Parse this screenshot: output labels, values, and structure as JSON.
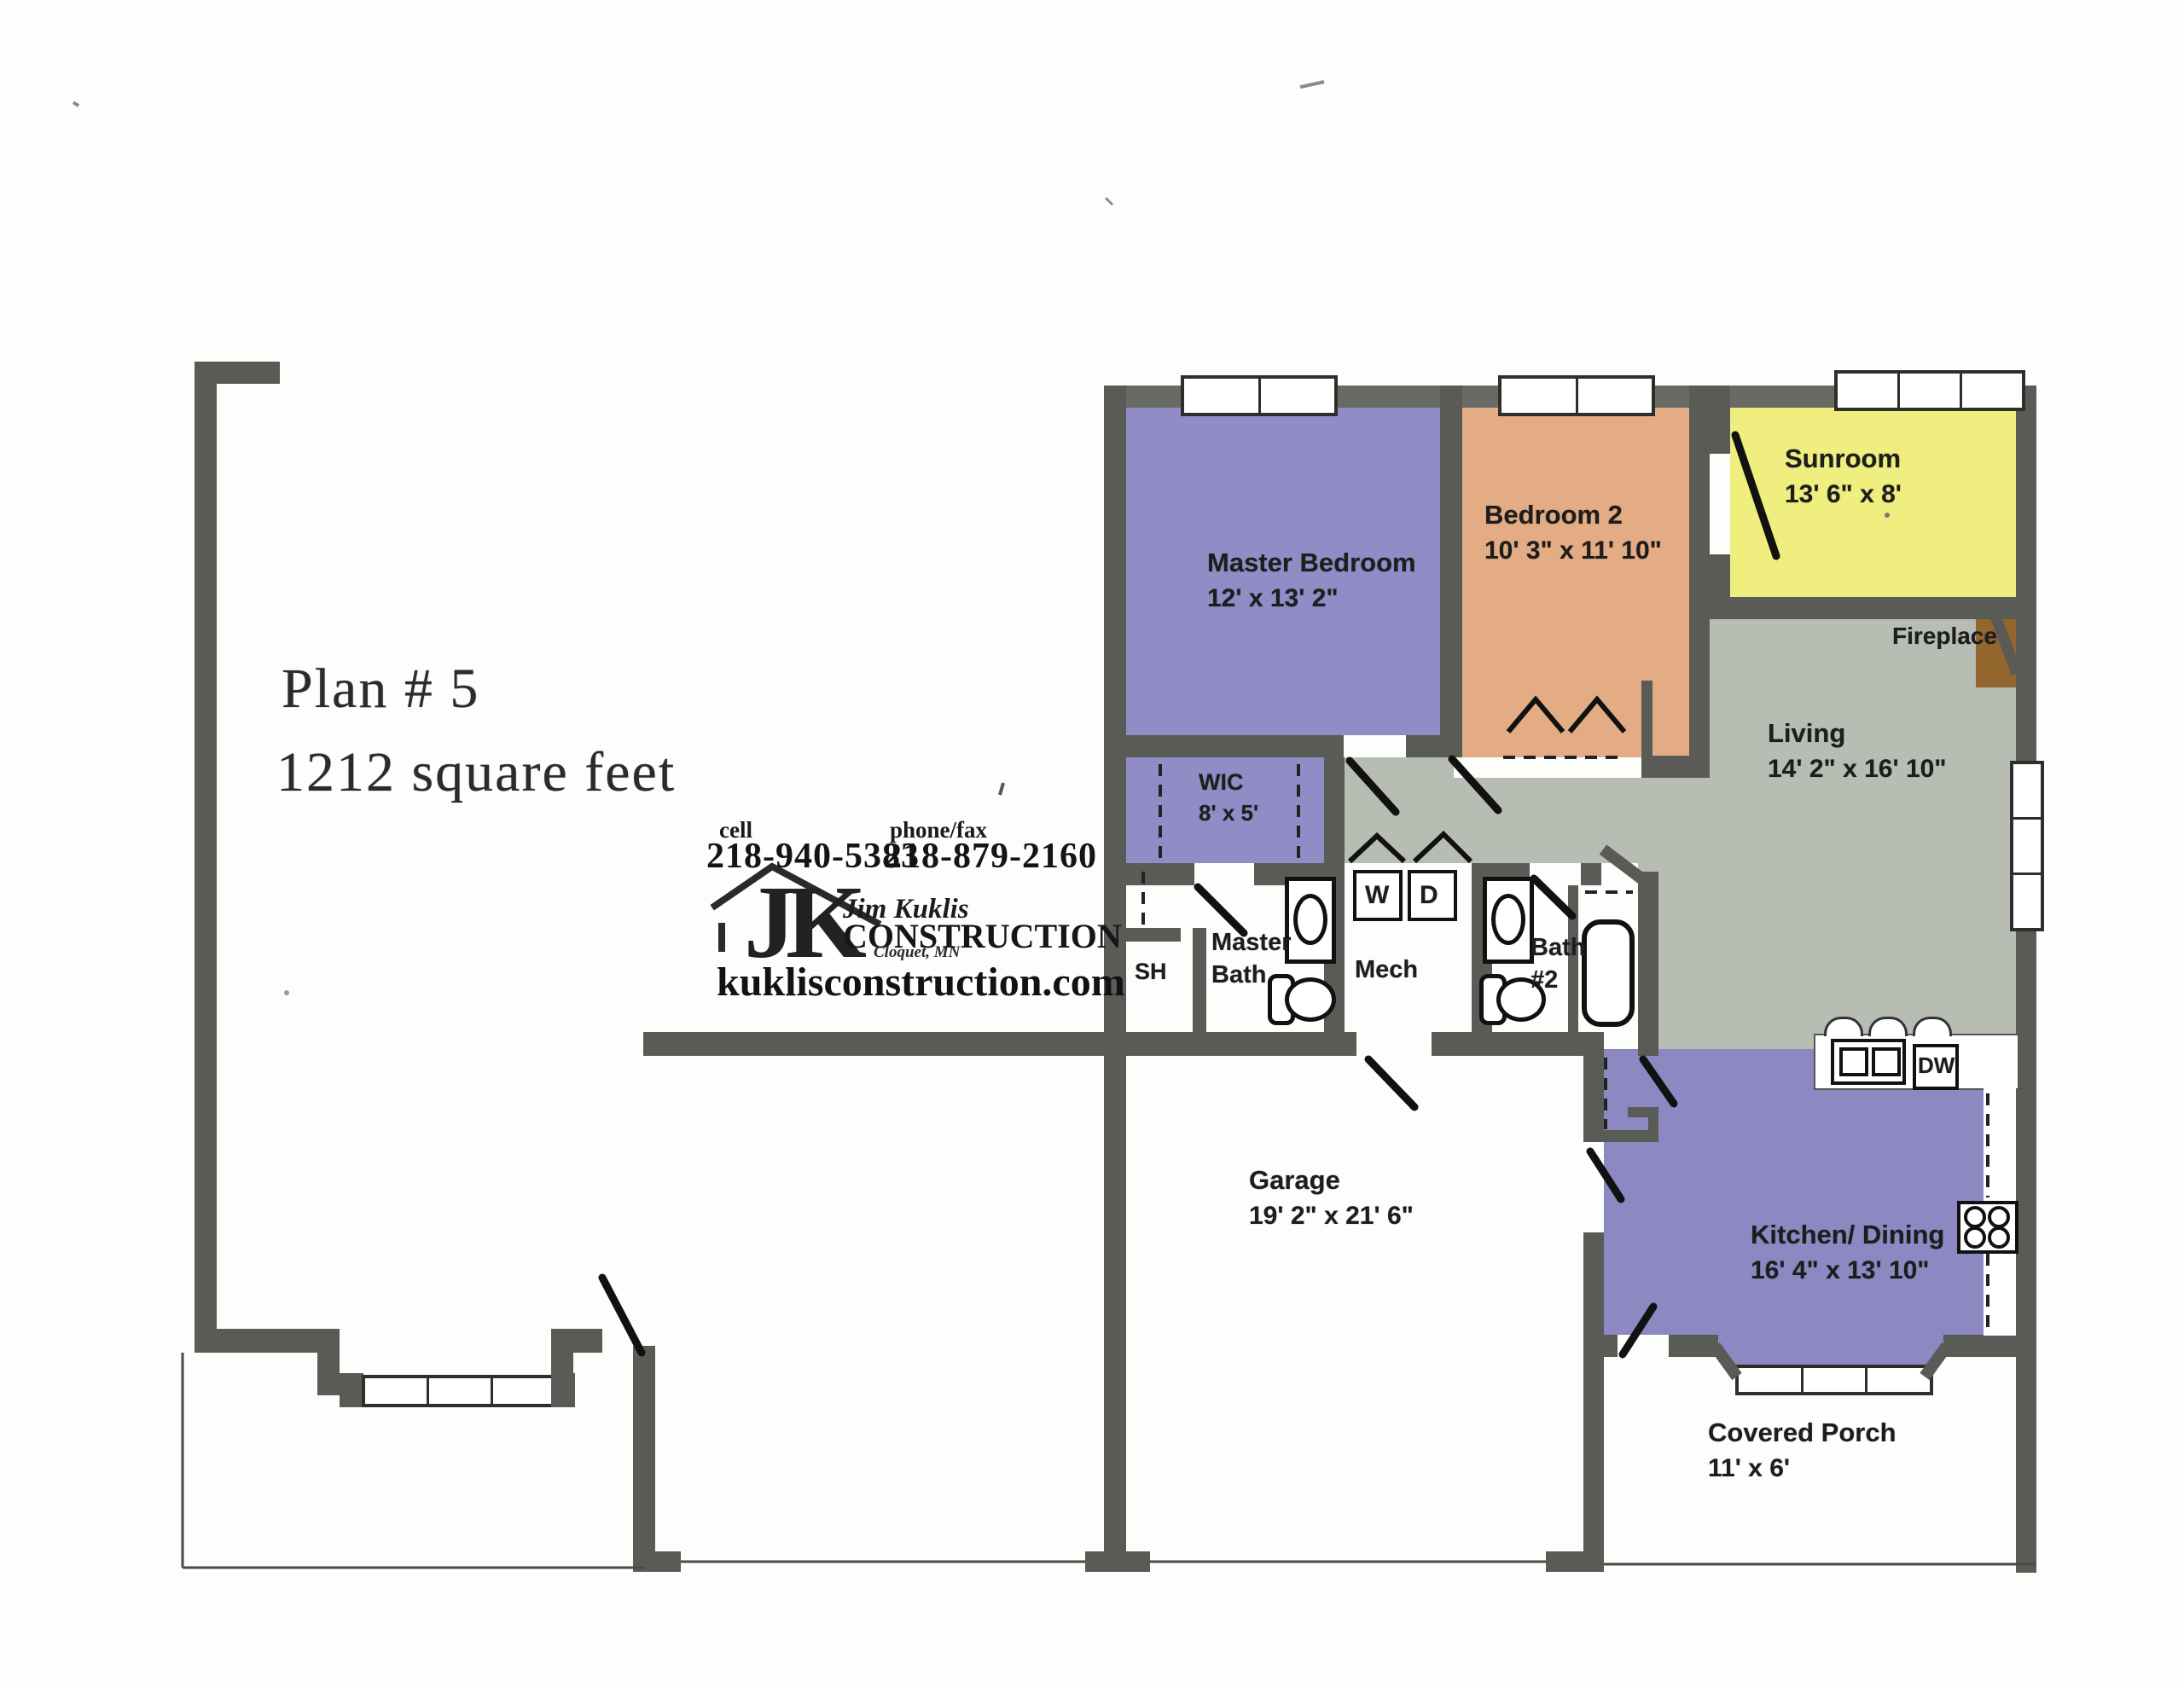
{
  "title": {
    "line1": "Plan # 5",
    "line2": "1212 square feet"
  },
  "contact": {
    "cell_label": "cell",
    "cell_number": "218-940-5383",
    "phone_label": "phone/fax",
    "phone_number": "218-879-2160",
    "website": "kuklisconstruction.com"
  },
  "logo": {
    "initials": "JK",
    "owner": "Jim Kuklis",
    "company": "CONSTRUCTION",
    "city": "Cloquet, MN"
  },
  "rooms": {
    "master_bedroom": {
      "name": "Master Bedroom",
      "dims": "12' x 13' 2\""
    },
    "bedroom2": {
      "name": "Bedroom 2",
      "dims": "10' 3\" x 11' 10\""
    },
    "sunroom": {
      "name": "Sunroom",
      "dims": "13' 6\" x 8'"
    },
    "living": {
      "name": "Living",
      "dims": "14' 2\" x 16' 10\""
    },
    "wic": {
      "name": "WIC",
      "dims": "8' x 5'"
    },
    "master_bath": {
      "line1": "Master",
      "line2": "Bath"
    },
    "shower": {
      "name": "SH"
    },
    "mech": {
      "name": "Mech"
    },
    "bath2": {
      "line1": "Bath",
      "line2": "#2"
    },
    "garage": {
      "name": "Garage",
      "dims": "19' 2\" x 21' 6\""
    },
    "kitchen": {
      "name": "Kitchen/ Dining",
      "dims": "16' 4\" x 13' 10\""
    },
    "porch": {
      "name": "Covered Porch",
      "dims": "11' x 6'"
    },
    "fireplace": {
      "name": "Fireplace"
    }
  },
  "fixtures": {
    "washer": "W",
    "dryer": "D",
    "dishwasher": "DW"
  },
  "colors": {
    "bedroom_purple": "#8f8cc6",
    "wic_purple": "#8f8cc6",
    "kitchen_purple": "#8b88c2",
    "bedroom2_salmon": "#e3ac85",
    "sunroom_yellow": "#efee7f",
    "living_gray": "#b7bdb3",
    "fireplace_brown": "#93662e",
    "wall_gray": "#5a5a56"
  }
}
